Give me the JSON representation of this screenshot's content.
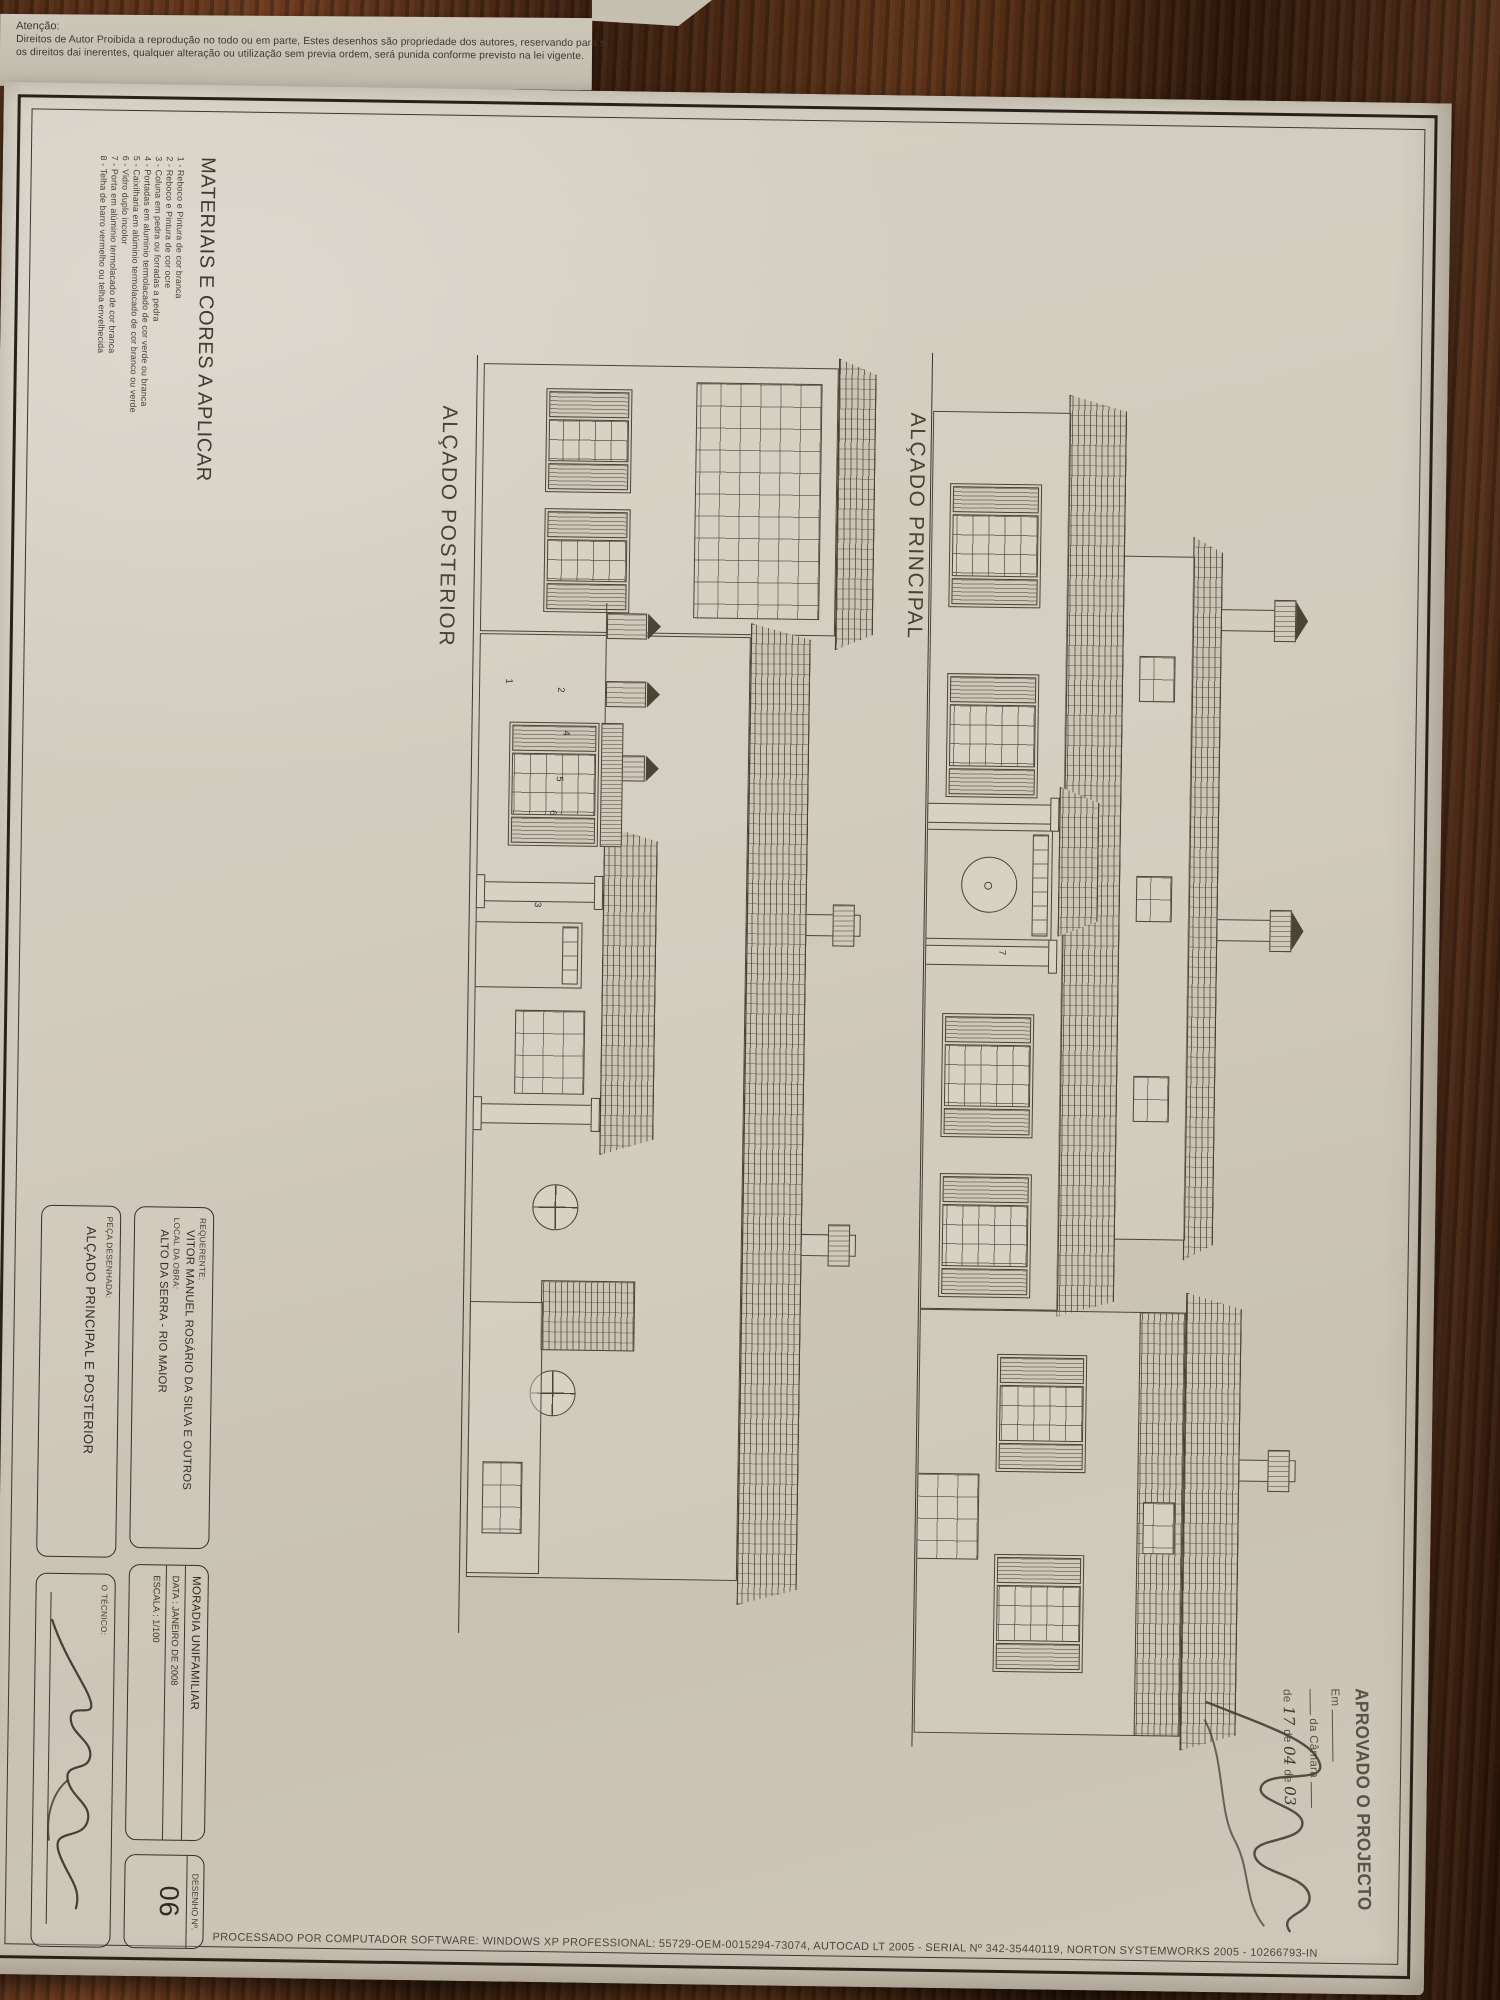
{
  "notice": {
    "heading": "Atenção:",
    "line1": "Direitos de Autor Proibida a reprodução no todo ou em parte, Estes desenhos são propriedade dos autores, reservando para si",
    "line2": "os direitos dai inerentes, qualquer alteração ou utilização sem previa ordem, será punida conforme previsto na lei vigente."
  },
  "materials": {
    "title": "MATERIAIS E CORES A APLICAR",
    "items": [
      "1 - Reboco e Pintura de cor branca",
      "2 - Reboco e Pintura de cor ocre",
      "3 - Coluna em pedra ou forradas a pedra",
      "4 - Portadas em aluminio termolacado de cor verde ou branca",
      "5 - Caixilharia em alúminio termolacado de cor branco ou verde",
      "6 - Vidro duplo incolor",
      "7 - Porta em alúminio termolacado de cor branca",
      "8 - Telha de barro vermelho ou telha envelhecida"
    ]
  },
  "drawings": {
    "principal_label": "ALÇADO PRINCIPAL",
    "posterior_label": "ALÇADO POSTERIOR",
    "callouts": {
      "c1": "1",
      "c2": "2",
      "c3": "3",
      "c4": "4",
      "c5": "5",
      "c6": "6",
      "c7": "7"
    }
  },
  "title_block": {
    "requerente_label": "REQUERENTE:",
    "requerente": "VITOR MANUEL ROSÁRIO DA SILVA E OUTROS",
    "local_label": "LOCAL DA OBRA:",
    "local": "ALTO DA SERRA - RIO MAIOR",
    "moradia": "MORADIA UNIFAMILIAR",
    "data": "DATA : JANEIRO DE 2008",
    "escala": "ESCALA : 1/100",
    "desenho_label": "DESENHO Nº.",
    "desenho_numero": "06",
    "peca_label": "PEÇA DESENHADA:",
    "peca": "ALÇADO PRINCIPAL E POSTERIOR",
    "tecnico_label": "O TÉCNICO:"
  },
  "stamp": {
    "title": "APROVADO O PROJECTO",
    "em": "Em",
    "camara": "da Câmara",
    "de1": "de",
    "dia": "17",
    "de2": "de",
    "mes": "04",
    "de3": "de",
    "ano": "03"
  },
  "footer": {
    "plotter_line": "PROCESSADO POR COMPUTADOR SOFTWARE: WINDOWS XP PROFESSIONAL: 55729-OEM-0015294-73074, AUTOCAD LT 2005 - SERIAL Nº 342-35440119, NORTON SYSTEMWORKS 2005 - 10266793-IN"
  }
}
